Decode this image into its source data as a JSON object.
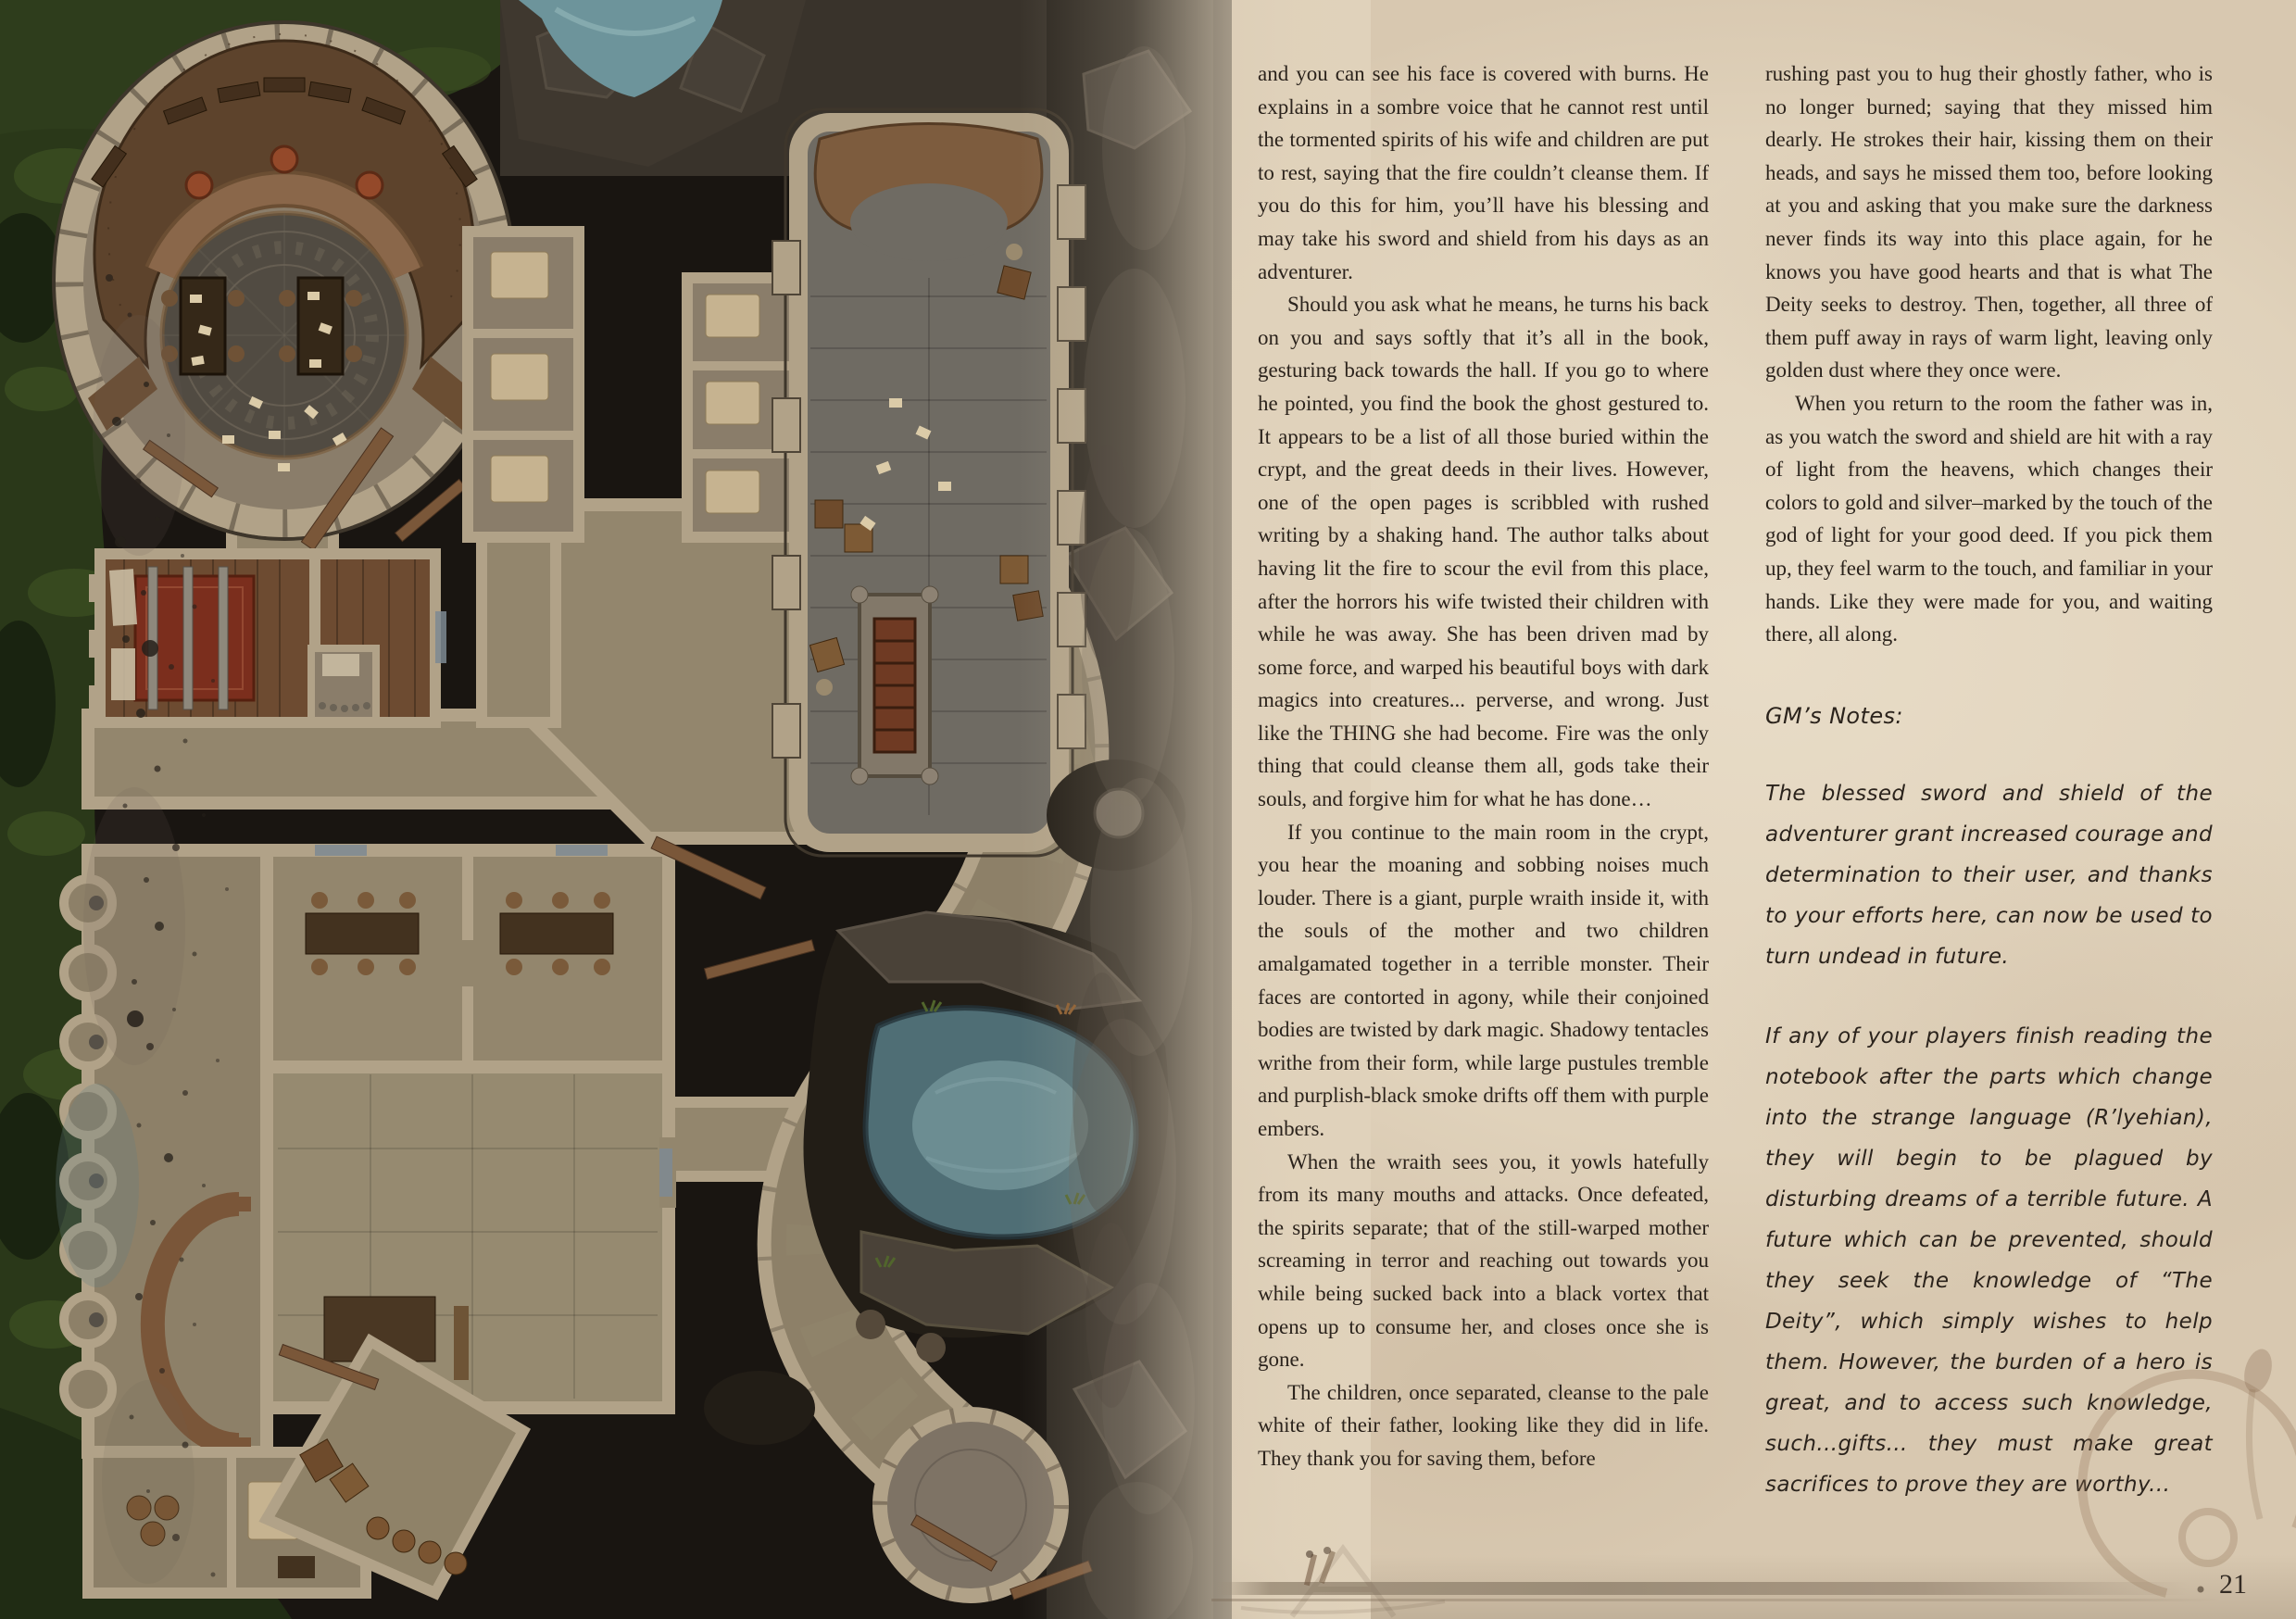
{
  "page": {
    "background_color": "#e0d2bb",
    "text_color": "#2b231c"
  },
  "map": {
    "description": "top-down-crypt-dungeon-battle-map",
    "palette": {
      "background": "#191511",
      "foliage": "#2a3819",
      "rock": "#39332b",
      "stone_wall": "#b1a288",
      "stone_floor": "#93866d",
      "hall_floor": "#6f6b63",
      "wood": "#5d432c",
      "carpet": "#7b2e1d",
      "water": "#4f6e75",
      "mosaic": "#514b42",
      "bed": "#c6b390"
    }
  },
  "story": {
    "column1": [
      "and you can see his face is covered with burns. He explains in a sombre voice that he cannot rest until the tormented spirits of his wife and children are put to rest, saying that the fire couldn’t cleanse them. If you do this for him, you’ll have his blessing and may take his sword and shield from his days as an adventurer.",
      "Should you ask what he means, he turns his back on you and says softly that it’s all in the book, gesturing back towards the hall. If you go to where he pointed, you find the book the ghost gestured to. It appears to be a list of all those buried within the crypt, and the great deeds in their lives. However, one of the open pages is scribbled with rushed writing by a shaking hand. The author talks about having lit the fire to scour the evil from this place, after the horrors his wife twisted their children with while he was away. She has been driven mad by some force, and warped his beautiful boys with dark magics into creatures... perverse, and wrong. Just like the THING she had become. Fire was the only thing that could cleanse them all, gods take their souls, and forgive him for what he has done…",
      "If you continue to the main room in the crypt, you hear the moaning and sobbing noises much louder. There is a giant, purple wraith inside it, with the souls of the mother and two children amalgamated together in a terrible monster. Their faces are contorted in agony, while their conjoined bodies are twisted by dark magic. Shadowy tentacles writhe from their form, while large pustules tremble and purplish-black smoke drifts off them with purple embers.",
      "When the wraith sees you, it yowls hatefully from its many mouths and attacks. Once defeated, the spirits separate; that of the still-warped mother screaming in terror and reaching out towards you while being sucked back into a black vortex that opens up to consume her, and closes once she is gone.",
      "The children, once separated, cleanse to the pale white of their father, looking like they did in life. They thank you for saving them, before"
    ],
    "column2": [
      "rushing past you to hug their ghostly father, who is no longer burned; saying that they missed him dearly. He strokes their hair, kissing them on their heads, and says he missed them too, before looking at you and asking that you make sure the darkness never finds its way into this place again, for he knows you have good hearts and that is what The Deity seeks to destroy. Then, together, all three of them puff away in rays of warm light, leaving only golden dust where they once were.",
      "When you return to the room the father was in, as you watch the sword and shield are hit with a ray of light from the heavens, which changes their colors to gold and silver–marked by the touch of the god of light for your good deed. If you pick them up, they feel warm to the touch, and familiar in your hands. Like they were made for you, and waiting there, all along."
    ]
  },
  "gm_notes": {
    "heading": "GM’s Notes:",
    "paragraphs": [
      "The blessed sword and shield of the adventurer grant increased courage and determination to their user, and thanks to your efforts here, can now be used to turn undead in future.",
      "If any of your players finish reading the notebook after the parts which change into the strange language (R’lyehian), they will begin to be plagued by disturbing dreams of a terrible future. A future which can be prevented, should they seek the knowledge of “The Deity”, which simply wishes to help them. However, the burden of a hero is great, and to access such knowledge, such...gifts... they must make great sacrifices to prove they are worthy..."
    ]
  },
  "footer": {
    "page_number": "21"
  }
}
